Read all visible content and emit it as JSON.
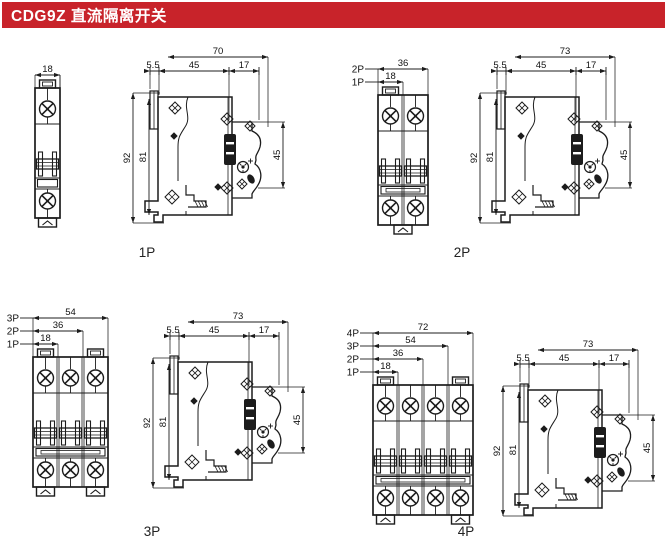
{
  "header": {
    "title": "CDG9Z 直流隔离开关",
    "background": "#C8232A",
    "text_color": "#FFFFFF"
  },
  "drawing": {
    "line_color": "#1C1C1C",
    "groups": [
      {
        "id": "1p",
        "caption": "1P",
        "poles": 1,
        "front_dims": [
          {
            "label": "",
            "value": "18"
          }
        ],
        "side_dims": {
          "total": "70",
          "segments": [
            "5.5",
            "45",
            "17"
          ],
          "height": "92",
          "inner_height": "81",
          "terminal_height": "45"
        }
      },
      {
        "id": "2p",
        "caption": "2P",
        "poles": 2,
        "front_dims": [
          {
            "label": "2P",
            "value": "36"
          },
          {
            "label": "1P",
            "value": "18"
          }
        ],
        "side_dims": {
          "total": "73",
          "segments": [
            "5.5",
            "45",
            "17"
          ],
          "height": "92",
          "inner_height": "81",
          "terminal_height": "45"
        }
      },
      {
        "id": "3p",
        "caption": "3P",
        "poles": 3,
        "front_dims": [
          {
            "label": "3P",
            "value": "54"
          },
          {
            "label": "2P",
            "value": "36"
          },
          {
            "label": "1P",
            "value": "18"
          }
        ],
        "side_dims": {
          "total": "73",
          "segments": [
            "5.5",
            "45",
            "17"
          ],
          "height": "92",
          "inner_height": "81",
          "terminal_height": "45"
        }
      },
      {
        "id": "4p",
        "caption": "4P",
        "poles": 4,
        "front_dims": [
          {
            "label": "4P",
            "value": "72"
          },
          {
            "label": "3P",
            "value": "54"
          },
          {
            "label": "2P",
            "value": "36"
          },
          {
            "label": "1P",
            "value": "18"
          }
        ],
        "side_dims": {
          "total": "73",
          "segments": [
            "5.5",
            "45",
            "17"
          ],
          "height": "92",
          "inner_height": "81",
          "terminal_height": "45"
        }
      }
    ]
  }
}
